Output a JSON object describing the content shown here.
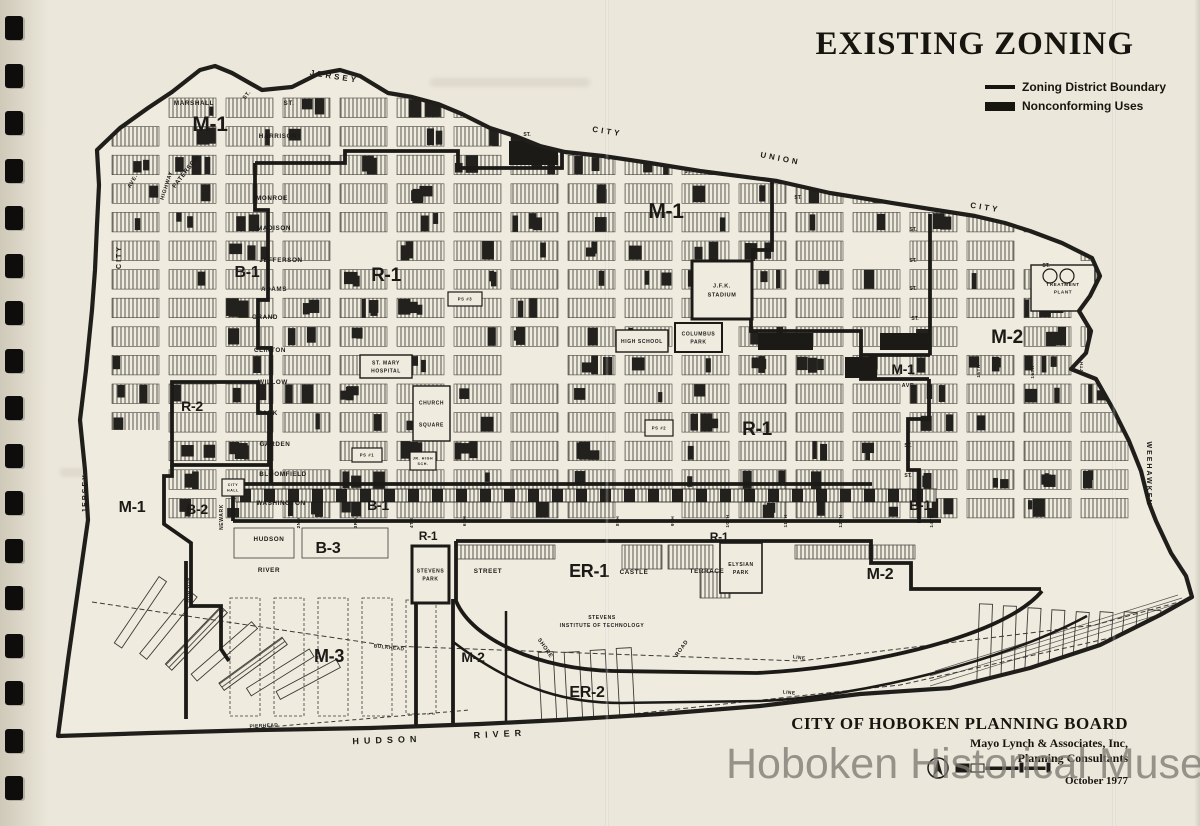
{
  "page": {
    "paper_color": "#ebe7da",
    "map_paper_color": "#efebdf",
    "ink_color": "#1b1a17",
    "watermark_color": "#7e7b73"
  },
  "binding": {
    "holes": 17
  },
  "title": "EXISTING ZONING",
  "legend": {
    "items": [
      {
        "label": "Zoning District Boundary",
        "swatch": "line"
      },
      {
        "label": "Nonconforming Uses",
        "swatch": "block"
      }
    ]
  },
  "attribution": {
    "line1": "CITY OF HOBOKEN PLANNING BOARD",
    "line2": "Mayo Lynch & Associates, Inc,",
    "line3": "Planning Consultants",
    "date": "October 1977"
  },
  "watermark": "Hoboken Historical Museum",
  "map": {
    "zones": [
      {
        "t": "M-1",
        "x": 210,
        "y": 131,
        "s": 21
      },
      {
        "t": "B-1",
        "x": 247,
        "y": 277,
        "s": 16
      },
      {
        "t": "R-1",
        "x": 386,
        "y": 281,
        "s": 19
      },
      {
        "t": "M-1",
        "x": 666,
        "y": 218,
        "s": 21
      },
      {
        "t": "M-2",
        "x": 1007,
        "y": 343,
        "s": 19
      },
      {
        "t": "M-1",
        "x": 903,
        "y": 374,
        "s": 14
      },
      {
        "t": "R-2",
        "x": 192,
        "y": 411,
        "s": 14
      },
      {
        "t": "R-1",
        "x": 757,
        "y": 435,
        "s": 19
      },
      {
        "t": "M-1",
        "x": 132,
        "y": 512,
        "s": 16
      },
      {
        "t": "B-2",
        "x": 197,
        "y": 514,
        "s": 14
      },
      {
        "t": "B-1",
        "x": 378,
        "y": 510,
        "s": 14
      },
      {
        "t": "B-1",
        "x": 920,
        "y": 510,
        "s": 14
      },
      {
        "t": "B-3",
        "x": 328,
        "y": 553,
        "s": 16
      },
      {
        "t": "R-1",
        "x": 428,
        "y": 540,
        "s": 12
      },
      {
        "t": "R-1",
        "x": 719,
        "y": 541,
        "s": 12
      },
      {
        "t": "ER-1",
        "x": 589,
        "y": 577,
        "s": 18
      },
      {
        "t": "M-2",
        "x": 880,
        "y": 579,
        "s": 16
      },
      {
        "t": "M-3",
        "x": 329,
        "y": 662,
        "s": 18
      },
      {
        "t": "M-2",
        "x": 473,
        "y": 662,
        "s": 14
      },
      {
        "t": "ER-2",
        "x": 587,
        "y": 697,
        "s": 16
      }
    ],
    "streets": [
      {
        "t": "MARSHALL",
        "x": 194,
        "y": 105
      },
      {
        "t": "ST.",
        "x": 289,
        "y": 105
      },
      {
        "t": "HARRISON",
        "x": 278,
        "y": 138
      },
      {
        "t": "MONROE",
        "x": 272,
        "y": 200
      },
      {
        "t": "MADISON",
        "x": 274,
        "y": 230
      },
      {
        "t": "JEFFERSON",
        "x": 281,
        "y": 262
      },
      {
        "t": "ADAMS",
        "x": 274,
        "y": 291
      },
      {
        "t": "GRAND",
        "x": 265,
        "y": 319
      },
      {
        "t": "CLINTON",
        "x": 270,
        "y": 352
      },
      {
        "t": "WILLOW",
        "x": 273,
        "y": 384
      },
      {
        "t": "PARK",
        "x": 268,
        "y": 415
      },
      {
        "t": "GARDEN",
        "x": 275,
        "y": 446
      },
      {
        "t": "BLOOMFIELD",
        "x": 283,
        "y": 476
      },
      {
        "t": "WASHINGTON",
        "x": 281,
        "y": 505
      },
      {
        "t": "HUDSON",
        "x": 269,
        "y": 541
      },
      {
        "t": "RIVER",
        "x": 269,
        "y": 572
      },
      {
        "t": "STREET",
        "x": 488,
        "y": 573
      },
      {
        "t": "CASTLE",
        "x": 634,
        "y": 574
      },
      {
        "t": "TERRACE",
        "x": 707,
        "y": 573
      },
      {
        "t": "AVE.",
        "x": 909,
        "y": 387,
        "s": 5.5
      },
      {
        "t": "PATERSON",
        "x": 187,
        "y": 173,
        "r": -52
      },
      {
        "t": "HIGHWAY",
        "x": 168,
        "y": 186,
        "r": -72,
        "s": 5.5
      },
      {
        "t": "AVE.",
        "x": 134,
        "y": 182,
        "r": -60,
        "s": 5.5
      },
      {
        "t": "ST.",
        "x": 248,
        "y": 96,
        "r": -52,
        "s": 5.5
      },
      {
        "t": "NEWARK",
        "x": 223,
        "y": 517,
        "r": -90,
        "s": 5
      },
      {
        "t": "HUDSON",
        "x": 190,
        "y": 590,
        "r": -90,
        "s": 5
      },
      {
        "t": "SHORE",
        "x": 544,
        "y": 649,
        "r": 55,
        "s": 5.5
      },
      {
        "t": "ROAD",
        "x": 683,
        "y": 649,
        "r": -55,
        "s": 5.5
      }
    ],
    "street_ticks": [
      {
        "t": "ST.",
        "x": 527,
        "y": 136
      },
      {
        "t": "ST.",
        "x": 688,
        "y": 173
      },
      {
        "t": "ST.",
        "x": 798,
        "y": 199
      },
      {
        "t": "ST.",
        "x": 913,
        "y": 231
      },
      {
        "t": "ST.",
        "x": 913,
        "y": 262
      },
      {
        "t": "ST.",
        "x": 913,
        "y": 290
      },
      {
        "t": "ST.",
        "x": 915,
        "y": 320
      },
      {
        "t": "ST.",
        "x": 1046,
        "y": 267
      },
      {
        "t": "ST.",
        "x": 908,
        "y": 447
      },
      {
        "t": "ST.",
        "x": 908,
        "y": 477
      }
    ],
    "numbered_streets": [
      {
        "t": "2ND",
        "x": 300,
        "y": 523
      },
      {
        "t": "3RD",
        "x": 357,
        "y": 523
      },
      {
        "t": "4TH",
        "x": 413,
        "y": 523
      },
      {
        "t": "6TH",
        "x": 466,
        "y": 521
      },
      {
        "t": "8TH",
        "x": 619,
        "y": 521
      },
      {
        "t": "9TH",
        "x": 674,
        "y": 521
      },
      {
        "t": "10TH",
        "x": 729,
        "y": 521
      },
      {
        "t": "11TH",
        "x": 787,
        "y": 521
      },
      {
        "t": "12TH",
        "x": 842,
        "y": 521
      },
      {
        "t": "14TH",
        "x": 933,
        "y": 521
      },
      {
        "t": "15TH",
        "x": 980,
        "y": 371
      },
      {
        "t": "16TH",
        "x": 1034,
        "y": 372
      },
      {
        "t": "17TH",
        "x": 1083,
        "y": 368
      }
    ],
    "boundaries": [
      {
        "t": "JERSEY",
        "x": 334,
        "y": 79,
        "r": 9
      },
      {
        "t": "CITY",
        "x": 607,
        "y": 134,
        "r": 9
      },
      {
        "t": "UNION",
        "x": 780,
        "y": 161,
        "r": 11
      },
      {
        "t": "CITY",
        "x": 985,
        "y": 210,
        "r": 9
      },
      {
        "t": "CITY",
        "x": 121,
        "y": 257,
        "r": -90,
        "s": 7,
        "ls": 2
      },
      {
        "t": "JERSEY",
        "x": 87,
        "y": 493,
        "r": -90,
        "s": 7,
        "ls": 2
      },
      {
        "t": "WEEHAWKEN",
        "x": 1147,
        "y": 474,
        "r": 90,
        "s": 7,
        "ls": 2
      }
    ],
    "water": [
      {
        "t": "BULKHEAD",
        "x": 389,
        "y": 649,
        "r": 6
      },
      {
        "t": "PIERHEAD",
        "x": 264,
        "y": 727,
        "r": -3
      },
      {
        "t": "LINE",
        "x": 799,
        "y": 659,
        "r": 8
      },
      {
        "t": "LINE",
        "x": 789,
        "y": 694,
        "r": 6
      },
      {
        "t": "HUDSON",
        "x": 387,
        "y": 743,
        "r": -2,
        "s": 9,
        "ls": 5
      },
      {
        "t": "RIVER",
        "x": 500,
        "y": 737,
        "r": -3,
        "s": 9,
        "ls": 5
      }
    ],
    "landmarks": [
      {
        "id": "jfk-stadium",
        "lines": [
          "J.F.K.",
          "STADIUM"
        ],
        "x": 692,
        "y": 261,
        "w": 60,
        "h": 58,
        "bw": 3,
        "ts": 5.5
      },
      {
        "id": "columbus-park",
        "lines": [
          "COLUMBUS",
          "PARK"
        ],
        "x": 675,
        "y": 323,
        "w": 47,
        "h": 29,
        "bw": 2,
        "ts": 5
      },
      {
        "id": "high-school",
        "lines": [
          "HIGH SCHOOL"
        ],
        "x": 616,
        "y": 330,
        "w": 52,
        "h": 22,
        "bw": 1.4,
        "ts": 5
      },
      {
        "id": "st-mary-hospital",
        "lines": [
          "ST. MARY",
          "HOSPITAL"
        ],
        "x": 360,
        "y": 355,
        "w": 52,
        "h": 23,
        "bw": 1.4,
        "ts": 5
      },
      {
        "id": "church-square",
        "lines": [
          "CHURCH",
          "SQUARE"
        ],
        "x": 413,
        "y": 386,
        "w": 37,
        "h": 55,
        "bw": 1.4,
        "ts": 5,
        "lh": 22
      },
      {
        "id": "stevens-park",
        "lines": [
          "STEVENS",
          "PARK"
        ],
        "x": 412,
        "y": 546,
        "w": 37,
        "h": 57,
        "bw": 3,
        "ts": 5
      },
      {
        "id": "elysian-park",
        "lines": [
          "ELYSIAN",
          "PARK"
        ],
        "x": 720,
        "y": 543,
        "w": 42,
        "h": 50,
        "bw": 1.6,
        "ts": 5
      },
      {
        "id": "treatment-plant",
        "lines": [
          "TREATMENT",
          "PLANT"
        ],
        "x": 1031,
        "y": 265,
        "w": 64,
        "h": 46,
        "bw": 1.4,
        "ts": 4.6,
        "circles": [
          [
            1050,
            276,
            7
          ],
          [
            1067,
            276,
            7
          ]
        ]
      },
      {
        "id": "city-hall",
        "lines": [
          "CITY",
          "HALL"
        ],
        "x": 222,
        "y": 479,
        "w": 22,
        "h": 17,
        "bw": 1.2,
        "ts": 3.6
      },
      {
        "id": "ps-3",
        "lines": [
          "PS #3"
        ],
        "x": 448,
        "y": 292,
        "w": 34,
        "h": 14,
        "bw": 1.2,
        "ts": 4.2
      },
      {
        "id": "ps-2",
        "lines": [
          "PS #2"
        ],
        "x": 645,
        "y": 420,
        "w": 28,
        "h": 16,
        "bw": 1.2,
        "ts": 4.2
      },
      {
        "id": "ps-1",
        "lines": [
          "PS #1"
        ],
        "x": 352,
        "y": 448,
        "w": 30,
        "h": 14,
        "bw": 1.2,
        "ts": 4.2
      },
      {
        "id": "jr-high-school",
        "lines": [
          "JR. HIGH",
          "SCH."
        ],
        "x": 410,
        "y": 452,
        "w": 26,
        "h": 18,
        "bw": 1.2,
        "ts": 3.6
      },
      {
        "id": "stevens-institute",
        "lines": [
          "STEVENS",
          "INSTITUTE OF TECHNOLOGY"
        ],
        "x": 540,
        "y": 608,
        "w": 124,
        "h": 26,
        "bw": 0,
        "ts": 5
      }
    ]
  }
}
